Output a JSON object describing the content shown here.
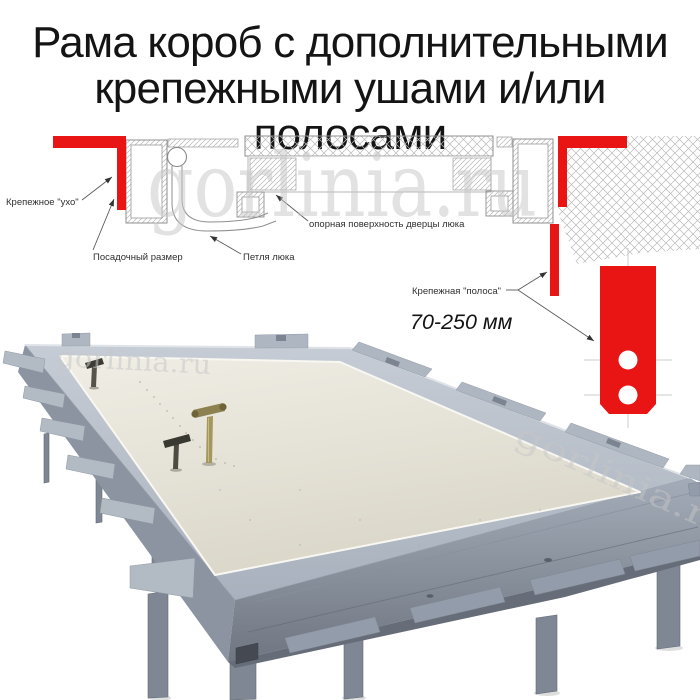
{
  "title": {
    "line1": "Рама короб с дополнительными",
    "line2": "крепежными ушами и/или полосами"
  },
  "diagram": {
    "labels": {
      "mounting_ear": "Крепежное \"ухо\"",
      "seating_dimension": "Посадочный размер",
      "hatch_hinge": "Петля люка",
      "door_support_surface": "опорная поверхность дверцы люка",
      "mounting_strip": "Крепежная \"полоса\"",
      "strip_length_range": "70-250 мм"
    }
  },
  "watermark": {
    "text": "gorlinia.ru"
  },
  "colors": {
    "accent_red": "#e91414",
    "frame_gray": "#9aa3af",
    "panel_cream": "#ece9de",
    "watermark_gray": "#c7c7c7",
    "title_ink": "#141414",
    "diagram_line": "#8f8f8f"
  }
}
